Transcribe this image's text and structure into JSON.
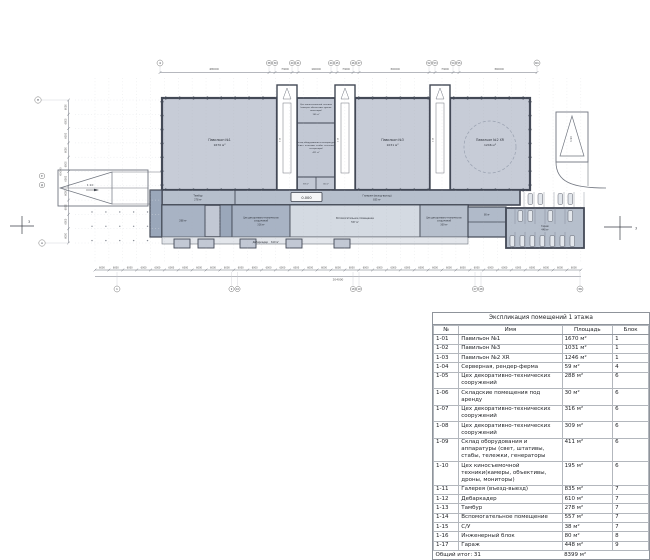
{
  "plan": {
    "level_marker": "0.000",
    "ramp_label": "1:10",
    "labels": {
      "pav1": {
        "name": "Павильон №1",
        "area": "1670 м²"
      },
      "pav3": {
        "name": "Павильон №3",
        "area": "1031 м²"
      },
      "pav2": {
        "name": "Павильон №2 XR",
        "area": "1246 м²"
      },
      "cinema": {
        "l1": "Цех киносъемочной техники",
        "l2": "(камеры, объективы, дроны,",
        "l3": "мониторы)",
        "area": "195 м²"
      },
      "equip": {
        "l1": "Склад оборудования и аппаратуры",
        "l2": "(свет, штативы, стабы, тележки,",
        "l3": "генераторы)",
        "area": "411 м²"
      },
      "server": {
        "area": "59 м²"
      },
      "rent": {
        "area": "30 м²"
      },
      "tambur": {
        "name": "Тамбур",
        "area": "278 м²"
      },
      "gallery": {
        "name": "Галерея (въезд-выезд)",
        "area": "835 м²"
      },
      "aux": {
        "name": "Вспомогательное помещение",
        "area": "557 м²"
      },
      "deco_a": {
        "area": "288 м²"
      },
      "deco_b": {
        "l1": "Цех декоративно-технических",
        "l2": "сооружений",
        "area": "316 м²"
      },
      "deco_c": {
        "l1": "Цех декоративно-технических",
        "l2": "сооружений",
        "area": "309 м²"
      },
      "debark": {
        "name": "Дебаркадер",
        "area": "610 м²"
      },
      "garage": {
        "name": "Гараж",
        "area": "448 м²"
      },
      "eng": {
        "area": "80 м²"
      }
    },
    "grid": {
      "top_bubbles": [
        "4",
        "38",
        "39",
        "40",
        "41",
        "44",
        "45",
        "46",
        "47",
        "52",
        "53",
        "54",
        "55",
        "61"
      ],
      "top_dims": [
        "48000",
        "7900",
        "16000",
        "7900",
        "30000",
        "7900",
        "36000"
      ],
      "left_bubbles": [
        "Н",
        "Е",
        "Д",
        "А"
      ],
      "bottom_bubbles": [
        "1",
        "9",
        "10",
        "18",
        "19",
        "27",
        "28",
        "36"
      ],
      "left_dim": "6000",
      "left_total": "60000",
      "left_dim_count": 10,
      "bottom_dim": "6000",
      "bottom_total": "204000",
      "bottom_dim_count": 35,
      "section_marker": "3"
    }
  },
  "table": {
    "title": "Экспликация помещений 1 этажа",
    "columns": [
      "№",
      "Имя",
      "Площадь",
      "Блок"
    ],
    "rows": [
      {
        "num": "1-01",
        "name": "Павильон №1",
        "area": "1670 м²",
        "block": "1"
      },
      {
        "num": "1-02",
        "name": "Павильон №3",
        "area": "1031 м²",
        "block": "1"
      },
      {
        "num": "1-03",
        "name": "Павильон №2 XR",
        "area": "1246 м²",
        "block": "1"
      },
      {
        "num": "1-04",
        "name": "Серверная, рендер-ферма",
        "area": "59 м²",
        "block": "4"
      },
      {
        "num": "1-05",
        "name": "Цех декоративно-технических сооружений",
        "area": "288 м²",
        "block": "6"
      },
      {
        "num": "1-06",
        "name": "Складские помещения под аренду",
        "area": "30 м²",
        "block": "6"
      },
      {
        "num": "1-07",
        "name": "Цех декоративно-технических сооружений",
        "area": "316 м²",
        "block": "6"
      },
      {
        "num": "1-08",
        "name": "Цех декоративно-технических сооружений",
        "area": "309 м²",
        "block": "6"
      },
      {
        "num": "1-09",
        "name": "Склад оборудования и аппаратуры (свет, штативы, стабы, тележки, генераторы",
        "area": "411 м²",
        "block": "6"
      },
      {
        "num": "1-10",
        "name": "Цех киносъемочной техники(камеры, объективы, дроны, мониторы)",
        "area": "195 м²",
        "block": "6"
      },
      {
        "num": "1-11",
        "name": "Галерея (въезд-выезд)",
        "area": "835 м²",
        "block": "7"
      },
      {
        "num": "1-12",
        "name": "Дебаркадер",
        "area": "610 м²",
        "block": "7"
      },
      {
        "num": "1-13",
        "name": "Тамбур",
        "area": "278 м²",
        "block": "7"
      },
      {
        "num": "1-14",
        "name": "Вспомогательное помещение",
        "area": "557 м²",
        "block": "7"
      },
      {
        "num": "1-15",
        "name": "С/У",
        "area": "38 м²",
        "block": "7"
      },
      {
        "num": "1-16",
        "name": "Инженерный блок",
        "area": "80 м²",
        "block": "8"
      },
      {
        "num": "1-17",
        "name": "Гараж",
        "area": "448 м²",
        "block": "9"
      }
    ],
    "footer": {
      "label": "Общий итог: 31",
      "area": "8399 м²"
    }
  },
  "colors": {
    "pavilion_fill": "#c7ccd7",
    "wall": "#434956",
    "medium_fill": "#b6bfcc",
    "dark_fill": "#9aa7ba",
    "light_fill": "#d4dae2",
    "dim_line": "#6d727c"
  }
}
